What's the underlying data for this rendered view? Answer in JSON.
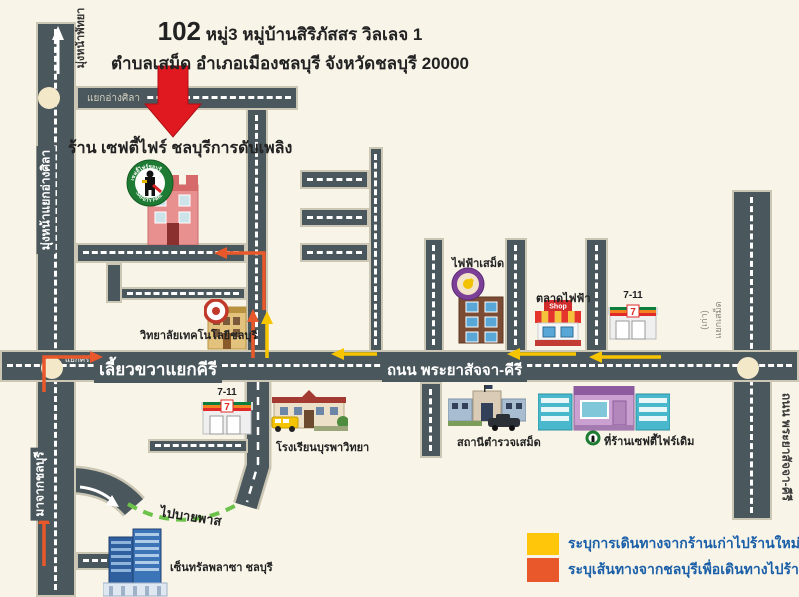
{
  "title": {
    "number": "102",
    "line1_rest": "หมู่3 หมู่บ้านสิริภัสสร วิลเลจ 1",
    "line2": "ตำบลเสม็ด อำเภอเมืองชลบุรี จังหวัดชลบุรี 20000"
  },
  "shop": {
    "label": "ร้าน เซฟตี้ไฟร์ ชลบุรีการดับเพลิง",
    "logo_top": "เซฟตี้ไฟร์ชลบุรี",
    "logo_bottom": "SAFETY FIRE"
  },
  "roads": {
    "to_pattaya": "มุ่งหน้าพัทยา",
    "left_road": "มุ่งหน้าแยกอ่างศิลา",
    "from_chonburi": "มาจากชลบุรี",
    "angsila_junction": "แยกอ่างศิลา",
    "kiri_junction": "แยกคีรี",
    "main_left": "เลี้ยวขวาแยกคีรี",
    "main_center": "ถนน พระยาสัจจา-คีรี",
    "right_road": "ถนน พระยาสัจจา-คีรี",
    "samed_old_line1": "แยกเสม็ด",
    "samed_old_line2": "(เก่า)",
    "bypass": "ไปบายพาส"
  },
  "landmarks": {
    "college": "วิทยาลัยเทคโนโลยีชลบุรี",
    "electricity": "ไฟฟ้าเสม็ด",
    "market": "ตลาดไฟฟ้า",
    "seven_upper": "7-11",
    "seven_lower": "7-11",
    "school": "โรงเรียนบุรพาวิทยา",
    "police": "สถานีตำรวจเสม็ด",
    "old_shop": "ที่ร้านเซฟตี้ไฟร์เดิม",
    "central": "เซ็นทรัลพลาซา ชลบุรี"
  },
  "icons": {
    "market_sign": "Shop",
    "seven_digit": "7"
  },
  "legend": {
    "items": [
      {
        "swatch": "#FFC60A",
        "label": "ระบุการเดินทางจากร้านเก่าไปร้านใหม่"
      },
      {
        "swatch": "#E9582A",
        "label": "ระบุเส้นทางจากชลบุรีเพื่อเดินทางไปร้านใหม่"
      }
    ]
  },
  "colors": {
    "background": "#F8F4E8",
    "road": "#4A575C",
    "road_border": "#CBC7B4",
    "route_old_shop_yellow": "#F7C500",
    "route_from_chonburi_orange": "#E9582A",
    "bypass_green": "#6CC24A",
    "pointer_red": "#E0181F",
    "legend_text_blue": "#1A5FA8"
  }
}
